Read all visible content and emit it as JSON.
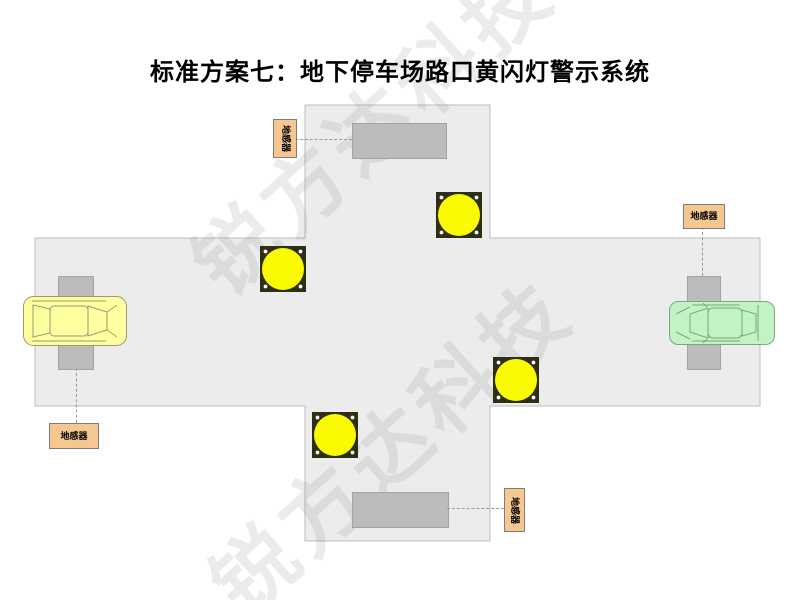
{
  "title": "标准方案七：地下停车场路口黄闪灯警示系统",
  "watermark": {
    "text": "锐方达科技"
  },
  "diagram": {
    "sensor_labels": {
      "top_left": "地感器",
      "right": "地感器",
      "bottom_left": "地感器",
      "bottom_right": "地感器"
    },
    "colors": {
      "road_fill": "#ececec",
      "road_border": "#bdbdbd",
      "sensor_fill": "#bcbcbc",
      "sensor_border": "#a3a3a3",
      "light_plate": "#2e2e14",
      "light_bulb": "#fafa00",
      "label_fill": "#f6c78e",
      "label_border": "#7d7d7d",
      "car_yellow_fill": "#ffffa0",
      "car_yellow_stroke": "#9a9a72",
      "car_green_fill": "#c2f3c6",
      "car_green_stroke": "#7aa87a",
      "dash_color": "#999999",
      "watermark_color": "rgba(130,130,130,0.16)"
    }
  }
}
